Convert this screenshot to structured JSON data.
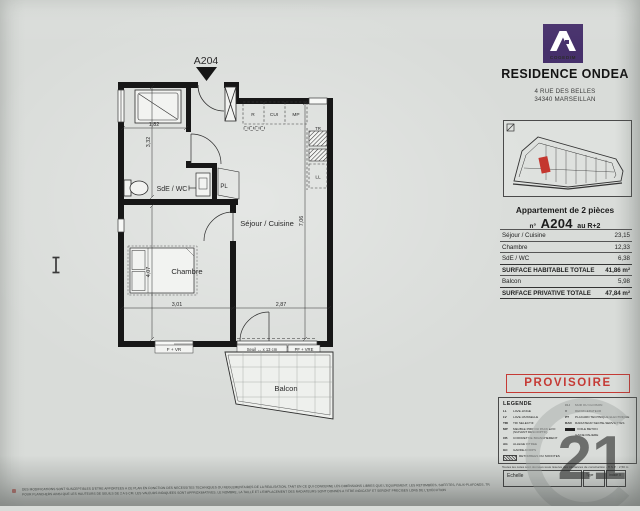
{
  "plan": {
    "unit_label": "A204",
    "rooms": {
      "bathroom": "SdE / WC",
      "closet": "PL",
      "living": "Séjour / Cuisine",
      "bedroom": "Chambre",
      "balcony": "Balcon"
    },
    "appliances": {
      "fridge": "R",
      "cooker": "CUI",
      "mp": "MP",
      "tr": "TR",
      "washer": "LL"
    },
    "dims": {
      "shower_width": "1,82",
      "bathroom_height": "3,32",
      "bedroom_height": "4,07",
      "bedroom_width": "3,01",
      "living_width": "2,87",
      "living_height": "7,06",
      "balcony_width": "3,17",
      "balcony_left": "1,55",
      "balcony_right": "2,16"
    },
    "openings": {
      "window_bedroom": "F + VR",
      "threshold": "Seuil ↔ x 13 cm",
      "window_living": "PF + VRE"
    }
  },
  "panel": {
    "brand": {
      "logo_text": "COGEDIM",
      "residence": "RESIDENCE ONDEA",
      "address_line1": "4 RUE DES BELLES",
      "address_line2": "34340 MARSEILLAN"
    },
    "apartment": {
      "type_label": "Appartement de 2 pièces",
      "number_prefix": "n°",
      "number": "A204",
      "floor": "au R+2"
    },
    "surface_table": {
      "rows": [
        {
          "label": "Séjour / Cuisine",
          "value": "23,15"
        },
        {
          "label": "Chambre",
          "value": "12,33"
        },
        {
          "label": "SdE / WC",
          "value": "6,38"
        },
        {
          "label": "SURFACE HABITABLE TOTALE",
          "value": "41,86 m²"
        },
        {
          "label": "Balcon",
          "value": "5,98"
        },
        {
          "label": "SURFACE PRIVATIVE TOTALE",
          "value": "47,84 m²"
        }
      ]
    },
    "stamp": "PROVISOIRE",
    "legend": {
      "title": "LEGENDE",
      "left": [
        {
          "abbr": "LL",
          "text": "LAVE-LINGE"
        },
        {
          "abbr": "LV",
          "text": "LAVE-VAISSELLE"
        },
        {
          "abbr": "TRI",
          "text": "TRI SELECTIF"
        },
        {
          "abbr": "MP",
          "text": "MEUBLE PMR OU PACK EVO (SUIVANT DESCRIPTIF)"
        },
        {
          "abbr": "CB",
          "text": "COFFRET DE BRANCHEMENT"
        },
        {
          "abbr": "AG",
          "text": "ALLEGE VITREE"
        },
        {
          "abbr": "GC",
          "text": "GARDE-CORPS"
        },
        {
          "abbr": "",
          "text": "RETOMBEES OU SOFFITES"
        }
      ],
      "right": [
        {
          "abbr": "CLI",
          "text": "MUR OU CLOISON"
        },
        {
          "abbr": "R",
          "text": "REFRIGERATEUR"
        },
        {
          "abbr": "PT",
          "text": "PLACARD TECHNIQUE ELECTRIQUE"
        },
        {
          "abbr": "RAD",
          "text": "RADIATEUR SECHE-SERVIETTES"
        },
        {
          "abbr": "",
          "text": "VOILE BETON"
        },
        {
          "abbr": "",
          "text": "GAINE PALIERE"
        }
      ]
    },
    "scale": {
      "caption": "Toutes les cotes sont données sous réserve des tolérances de construction - H.S.P. : 2,50 m",
      "echelle_label": "Echelle",
      "type_label": "Type",
      "indice_label": "Indice 0"
    }
  },
  "watermark": {
    "digits": "21"
  },
  "footer": {
    "line1": "DES MODIFICATIONS SONT SUSCEPTIBLES D'ETRE APPORTEES A CE PLAN EN FONCTION DES NECESSITES TECHNIQUES OU REGLEMENTAIRES DE LA REALISATION, TANT EN CE QUI CONCERNE LES DIMENSIONS LIBRES QUE L'EQUIPEMENT. LES RETOMBEES, SOFFITES, FAUX-PLAFONDS, TRAPPES DE VISITE SONT FIGURES",
    "line2": "POUR PLANCHERS AINSI QUE LES HAUTEURS DE SEUILS DE 2 A 5 CM. LES VALEURS INDIQUEES SONT APPROXIMATIVES. LE NOMBRE, LA TAILLE ET L'EMPLACEMENT DES RADIATEURS SONT DONNES A TITRE INDICATIF ET SERONT PRECISES LORS DE L'EXECUTION"
  },
  "colors": {
    "brand_purple": "#46306b",
    "stamp_red": "#c53a35",
    "unit_red": "#c4372f",
    "paper": "#d9dcd9"
  }
}
